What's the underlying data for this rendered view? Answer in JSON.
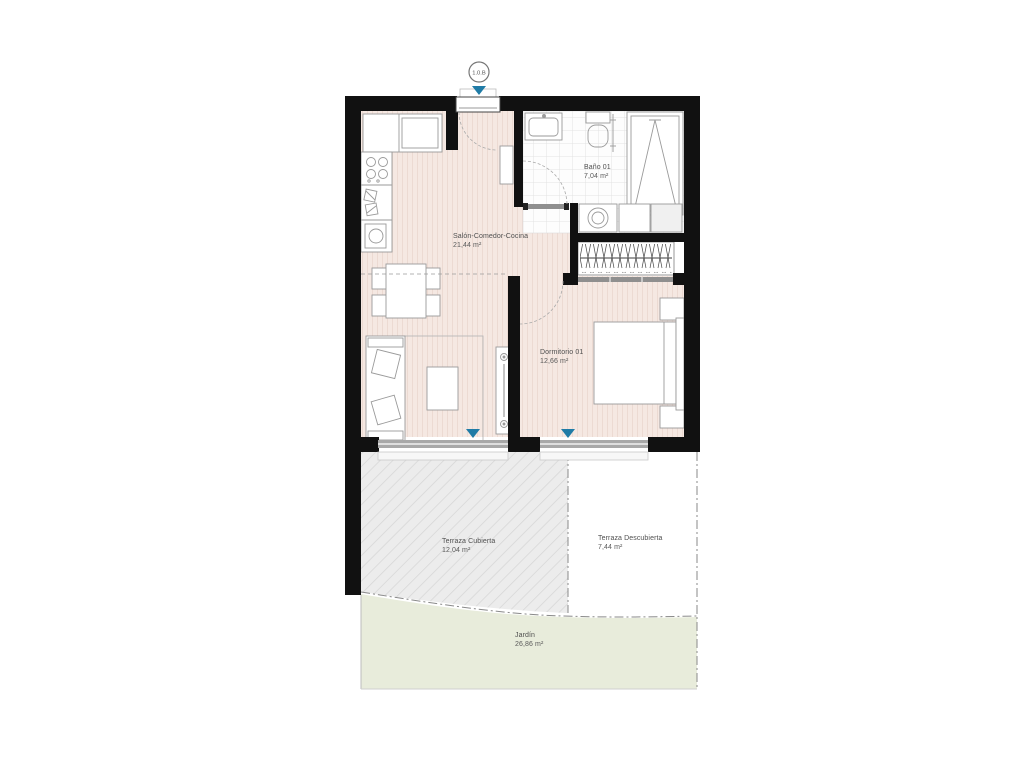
{
  "unit_label": "1.0.B",
  "plan": {
    "rooms": [
      {
        "id": "salon",
        "name": "Salón-Comedor-Cocina",
        "area": "21,44 m²"
      },
      {
        "id": "bano",
        "name": "Baño 01",
        "area": "7,04 m²"
      },
      {
        "id": "dormitorio",
        "name": "Dormitorio 01",
        "area": "12,66 m²"
      },
      {
        "id": "terraza-cubierta",
        "name": "Terraza Cubierta",
        "area": "12,04 m²"
      },
      {
        "id": "terraza-descubierta",
        "name": "Terraza Descubierta",
        "area": "7,44 m²"
      },
      {
        "id": "jardin",
        "name": "Jardín",
        "area": "26,86 m²"
      }
    ]
  },
  "colors": {
    "wall": "#111111",
    "interior_floor": "#f5e8e2",
    "bathroom_floor": "#fdfdfd",
    "terrace_covered": "#ececec",
    "garden": "#e8ecdb",
    "sill": "#a8a8a8",
    "marker_accent": "#1f7ba6"
  }
}
